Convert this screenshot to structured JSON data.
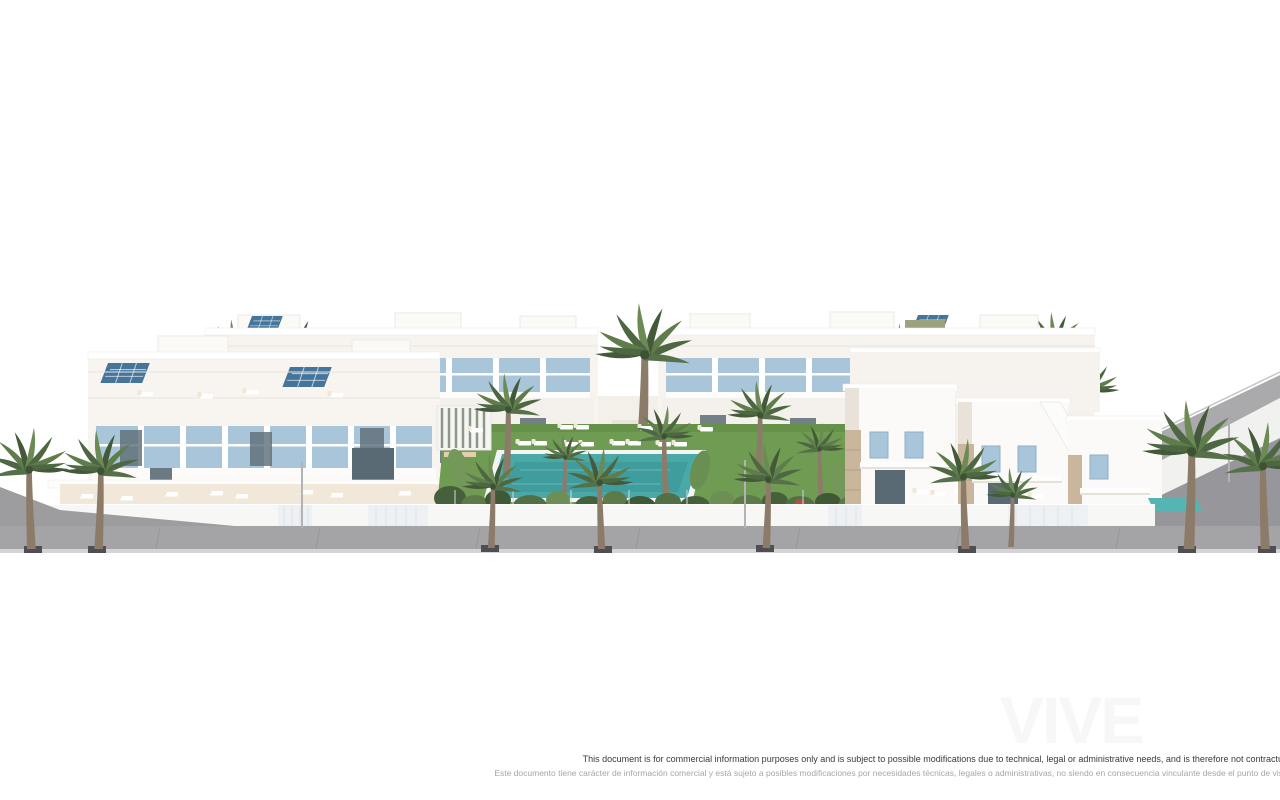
{
  "page": {
    "width": 1280,
    "height": 800,
    "background": "#ffffff"
  },
  "watermark": {
    "text": "VIVE",
    "color": "#f7f7f7"
  },
  "disclaimer": {
    "line_en": "This document is for commercial information purposes only and is subject to possible modifications due to technical, legal or administrative needs, and is therefore not contractual",
    "line_es": "Este documento tiene carácter de información comercial y está sujeto a posibles modificaciones por necesidades técnicas, legales o administrativas, no siendo en consecuencia vinculante desde el punto de vista",
    "color_en": "#3a3a3a",
    "color_es": "#a6a6a6"
  },
  "scene": {
    "description": "3D architectural render of a white Mediterranean residential complex: two rows of townhouses and stepped villas with light-blue shutters and windows, rooftop terraces with sun loungers and solar panels, a central communal garden with lawn, swimming pool, pergola and tropical planting, palm trees along a grey sidewalk, and a sloped access ramp on the right",
    "palette": {
      "building_white": "#fbfaf8",
      "warm_shadow": "#e8e2d8",
      "window_blue": "#a9c5da",
      "glass_dark": "#5a6a74",
      "solar_panel_blue": "#46759c",
      "lawn_green": "#6f9b52",
      "foliage_dark": "#47603c",
      "foliage_mid": "#5d7a49",
      "pool_turquoise": "#4aa8a6",
      "palm_trunk": "#8d7b69",
      "pavement_grey": "#a4a4a7",
      "pavement_light": "#d4d4d6",
      "perimeter_wall": "#f7f7f6",
      "stone_beige": "#c9b69c",
      "terrace_beige": "#f2e8da",
      "tree_base_dark": "#4e4e54"
    },
    "elements": [
      "back-townhouse-row",
      "mid-townhouse-row",
      "front-terraces",
      "communal-garden",
      "swimming-pool",
      "pergola",
      "sun-loungers",
      "right-villa-block",
      "private-pool",
      "access-ramp",
      "perimeter-wall",
      "sidewalk",
      "palm-trees",
      "solar-panels",
      "street-lamps"
    ]
  }
}
